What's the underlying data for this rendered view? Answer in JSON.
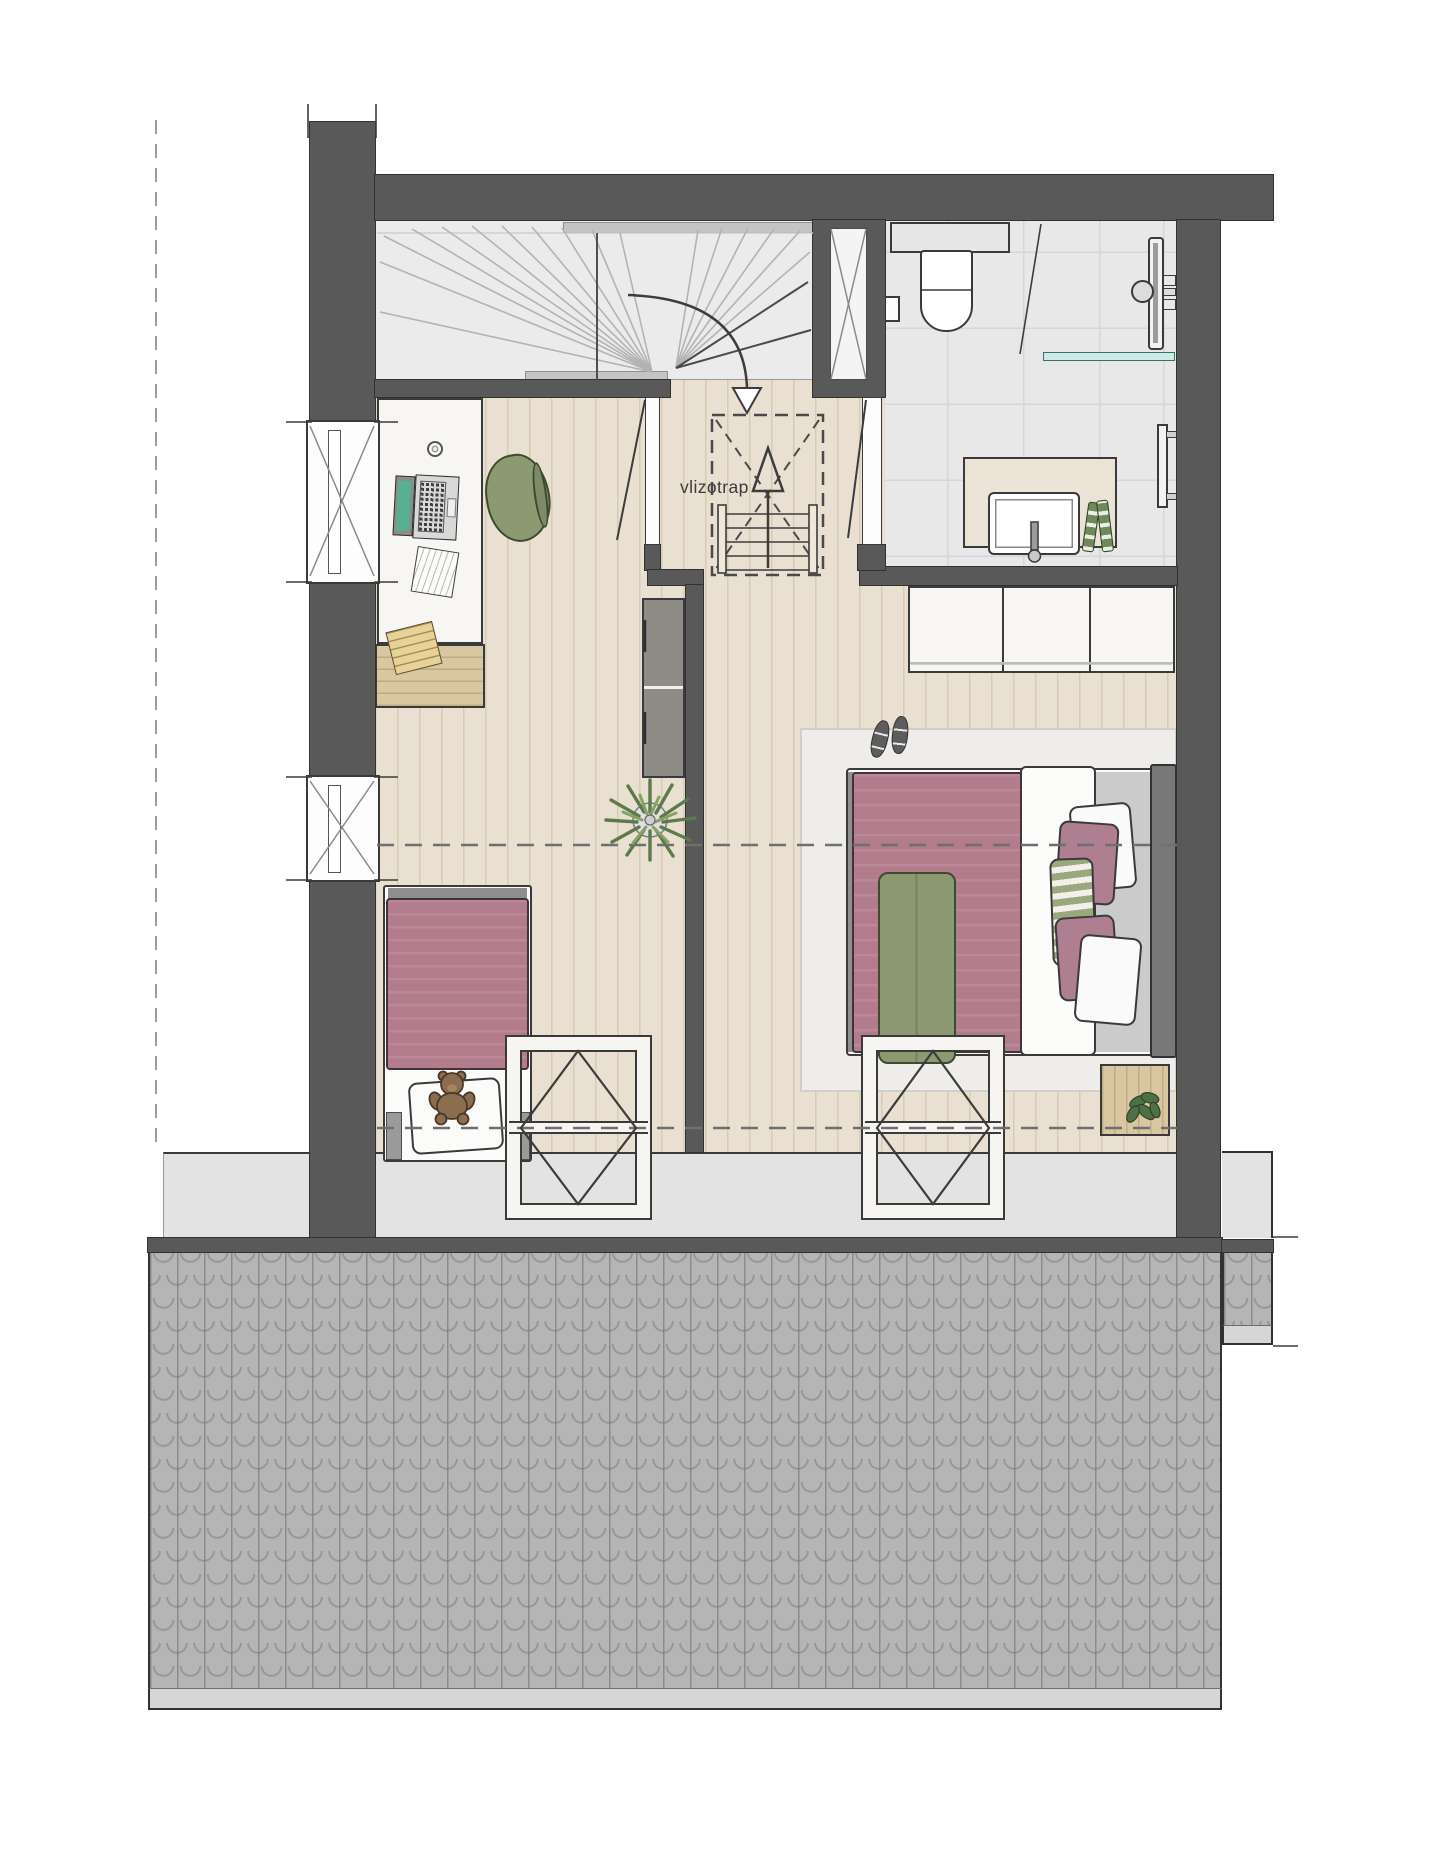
{
  "labels": {
    "vlizotrap": "vlizotrap"
  },
  "colors": {
    "wall": "#595959",
    "line": "#323232",
    "wood": "#e9e0d1",
    "wood-line": "#d7cbb7",
    "stair": "#ebebeb",
    "tile": "#e8e8e8",
    "tile-line": "#d6d6d6",
    "eaves": "#e3e3e3",
    "roof": "#b5b5b5",
    "gutter": "#d6d6d6",
    "white-furn": "#f7f6f3",
    "rug": "#eeedea",
    "duvet": "#b27c8c",
    "sage": "#8c9a72",
    "sage-dark": "#3e4a2f",
    "headboard": "#787878",
    "woodfurn": "#d9c7a2",
    "notepad": "#e7d297",
    "plant-green": "#5d7b4a",
    "teal": "#cdeae5",
    "teddy": "#8b6e50"
  }
}
